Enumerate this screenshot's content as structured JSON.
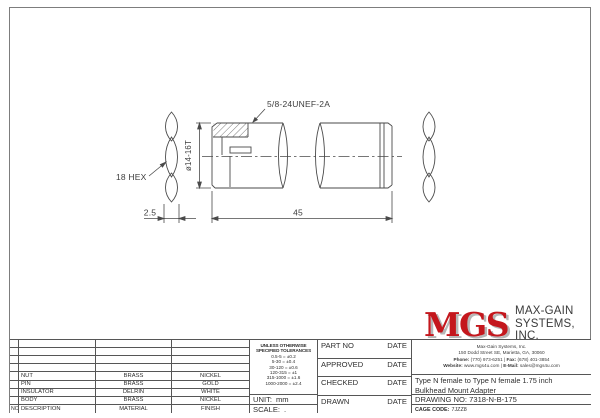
{
  "drawing": {
    "thread_callout": "5/8-24UNEF-2A",
    "diameter_dim": "ø14-16T",
    "hex_label": "18 HEX",
    "hex_thickness_dim": "2.5",
    "length_dim": "45"
  },
  "parts_table": {
    "headers": {
      "no": "NO.",
      "description": "DESCRIPTION",
      "material": "MATERIAL",
      "finish": "FINISH"
    },
    "rows": [
      {
        "description": "NUT",
        "material": "BRASS",
        "finish": "NICKEL"
      },
      {
        "description": "PIN",
        "material": "BRASS",
        "finish": "GOLD"
      },
      {
        "description": "INSULATOR",
        "material": "DELRIN",
        "finish": "WHITE"
      },
      {
        "description": "BODY",
        "material": "BRASS",
        "finish": "NICKEL"
      }
    ]
  },
  "tolerance_block": {
    "heading_line1": "UNLESS OTHERWISE",
    "heading_line2": "SPECIFIED TOLERANCES",
    "rows": [
      "0.5-5 = ±0.2",
      "5-30 = ±0.4",
      "30-120 = ±0.6",
      "120-315 = ±1",
      "315-1000 = ±1.6",
      "1000-2000 = ±2.4"
    ]
  },
  "unit": {
    "label": "UNIT:",
    "value": "mm"
  },
  "scale": {
    "label": "SCALE:",
    "value": "."
  },
  "signoff": {
    "rows": [
      {
        "label": "PART NO",
        "date": "DATE"
      },
      {
        "label": "APPROVED",
        "date": "DATE"
      },
      {
        "label": "CHECKED",
        "date": "DATE"
      },
      {
        "label": "DRAWN",
        "date": "DATE"
      }
    ]
  },
  "company": {
    "logo": "MGS",
    "name_line1": "MAX-GAIN",
    "name_line2": "SYSTEMS, INC.",
    "address_line1": "Max-Gain Systems, Inc.",
    "address_line2": "150 Dodd Street SE, Marietta, GA, 30060",
    "phone_label": "Phone:",
    "phone_value": " (770) 973-6251 | ",
    "fax_label": "Fax:",
    "fax_value": " (678) 401-3854",
    "web_label": "Website:",
    "web_value": " www.mgs4u.com | ",
    "email_label": "E-Mail:",
    "email_value": " sales@mgs4u.com"
  },
  "title_info": {
    "title_line1": "Type N female to Type N female 1.75 inch",
    "title_line2": "Bulkhead Mount Adapter",
    "drawing_no": "DRAWING NO: 7318-N-B-175",
    "cage_label": "CAGE CODE:",
    "cage_value": "7JZZ8"
  },
  "colors": {
    "logo_red": "#c4171d",
    "line": "#4a4a4a"
  }
}
